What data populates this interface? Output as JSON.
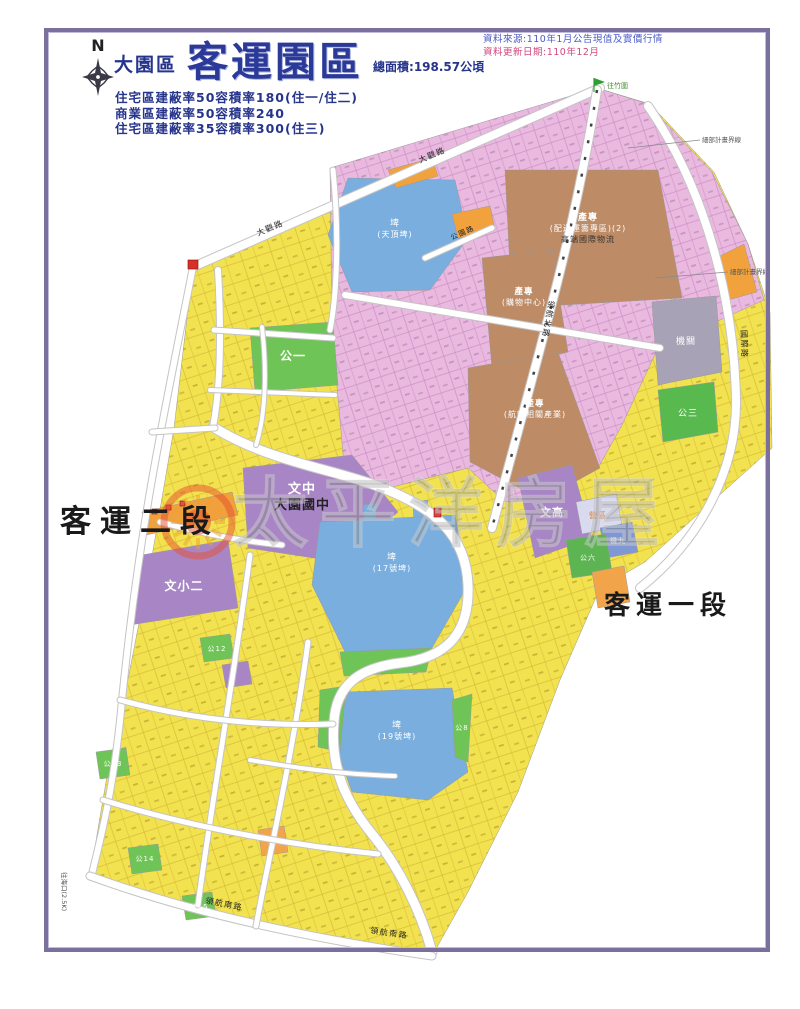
{
  "header": {
    "compass_n": "N",
    "district": "大園區",
    "title": "客運園區",
    "area": "總面積:198.57公頃",
    "regulations": [
      "住宅區建蔽率50容積率180(住一/住二)",
      "商業區建蔽率50容積率240",
      "住宅區建蔽率35容積率300(住三)"
    ],
    "source_line": "資料來源:110年1月公告現值及實價行情",
    "update_line": "資料更新日期:110年12月"
  },
  "palette": {
    "border": "#7a6f9d",
    "title_navy": "#2b3a98",
    "source_blue": "#4a5cc8",
    "source_red": "#d2487e",
    "residential_yellow": "#f2e24f",
    "commercial_pink": "#eab9df",
    "industry_brown": "#bd8b66",
    "pond_blue": "#79aede",
    "park_green": "#6fc457",
    "school_purple": "#a886c6",
    "agency_gray": "#a7a2b5",
    "strip_orange": "#f2a23c"
  },
  "map": {
    "boundary": {
      "name": "plan-area",
      "points": "193,267 480,132 597,88 650,104 714,172 748,244 770,312 772,448 645,562 600,588 560,680 518,792 468,892 432,956 300,932 180,903 90,876 108,770 124,700 152,556 174,428",
      "fill": "#f2e24f",
      "texture": "Y"
    },
    "zones": [
      {
        "name": "commercial-upper",
        "points": "330,168 597,88 648,104 712,172 748,244 764,300 658,348 622,425 598,468 540,498 505,502 468,468 420,480 380,490 345,476 332,330",
        "fill": "#eab9df",
        "texture": "P"
      },
      {
        "name": "pond-top",
        "points": "348,178 455,180 468,238 430,290 352,292 328,235",
        "fill": "#79aede",
        "labels": [
          {
            "t": "埤",
            "c": "#ffffff",
            "s": 9
          },
          {
            "t": "(天頂埤)",
            "c": "#ffffff",
            "s": 8
          }
        ],
        "lx": 395,
        "ly": 226
      },
      {
        "name": "orange-strip-a",
        "points": "388,170 432,158 438,176 396,188",
        "fill": "#f2a23c"
      },
      {
        "name": "orange-strip-b",
        "points": "452,214 490,206 495,230 458,238",
        "fill": "#f2a23c"
      },
      {
        "name": "orange-strip-c",
        "points": "716,258 744,244 757,292 728,300",
        "fill": "#f2a23c"
      },
      {
        "name": "industry-logistics",
        "points": "505,170 658,170 682,298 512,308",
        "fill": "#bd8b66",
        "labels": [
          {
            "t": "產專",
            "c": "#ffffff",
            "s": 9,
            "b": 1
          },
          {
            "t": "(配送運籌專區)(2)",
            "c": "#ffffff",
            "s": 8
          },
          {
            "t": "高端國際物流",
            "c": "#333333",
            "s": 8
          }
        ],
        "lx": 588,
        "ly": 220
      },
      {
        "name": "industry-mall",
        "points": "482,258 552,250 568,352 492,368",
        "fill": "#bd8b66",
        "labels": [
          {
            "t": "產專",
            "c": "#ffffff",
            "s": 8.5,
            "b": 1
          },
          {
            "t": "(購物中心)",
            "c": "#ffffff",
            "s": 8
          }
        ],
        "lx": 524,
        "ly": 294
      },
      {
        "name": "industry-aviation",
        "points": "468,368 558,352 600,468 542,500 470,462",
        "fill": "#bd8b66",
        "labels": [
          {
            "t": "產專",
            "c": "#ffffff",
            "s": 8.5,
            "b": 1
          },
          {
            "t": "(航空相關產業)",
            "c": "#ffffff",
            "s": 8
          }
        ],
        "lx": 535,
        "ly": 406
      },
      {
        "name": "agency",
        "points": "652,302 716,296 722,372 658,385",
        "fill": "#a7a2b5",
        "labels": [
          {
            "t": "機關",
            "c": "#ffffff",
            "s": 9
          }
        ],
        "lx": 686,
        "ly": 344
      },
      {
        "name": "park-3",
        "points": "658,390 714,382 718,432 663,442",
        "fill": "#57b94e",
        "labels": [
          {
            "t": "公三",
            "c": "#ffffff",
            "s": 9
          }
        ],
        "lx": 688,
        "ly": 416
      },
      {
        "name": "park-1",
        "points": "250,328 333,322 338,385 255,392",
        "fill": "#6fc457",
        "labels": [
          {
            "t": "公一",
            "c": "#ffffff",
            "s": 12,
            "b": 1
          }
        ],
        "lx": 293,
        "ly": 360
      },
      {
        "name": "school-junior-high",
        "points": "243,468 352,455 398,512 340,562 248,548",
        "fill": "#a886c6",
        "labels": [
          {
            "t": "文中",
            "c": "#ffffff",
            "s": 13,
            "b": 1
          },
          {
            "t": "大園國中",
            "c": "#222222",
            "s": 13,
            "b": 1
          }
        ],
        "lx": 302,
        "ly": 493
      },
      {
        "name": "school-elementary-2",
        "points": "136,556 228,540 238,608 130,625",
        "fill": "#a886c6",
        "labels": [
          {
            "t": "文小二",
            "c": "#ffffff",
            "s": 12,
            "b": 1
          }
        ],
        "lx": 184,
        "ly": 590
      },
      {
        "name": "orange-strip-left",
        "points": "142,512 232,492 238,515 146,535",
        "fill": "#f0a03c"
      },
      {
        "name": "pond-mid-inlet-1",
        "points": "363,505 377,503 375,528 365,528",
        "fill": "#79aede"
      },
      {
        "name": "pond-mid-inlet-2",
        "points": "413,502 428,500 426,528 414,528",
        "fill": "#79aede"
      },
      {
        "name": "pond-mid",
        "points": "320,522 455,515 468,585 432,648 345,652 312,585",
        "fill": "#79aede",
        "labels": [
          {
            "t": "埤",
            "c": "#ffffff",
            "s": 9
          },
          {
            "t": "(17號埤)",
            "c": "#ffffff",
            "s": 8
          }
        ],
        "lx": 392,
        "ly": 560
      },
      {
        "name": "park-between-ponds",
        "points": "340,652 432,648 426,672 344,676",
        "fill": "#6fc457"
      },
      {
        "name": "pond-low",
        "points": "348,692 452,688 468,772 428,800 352,792 334,742",
        "fill": "#79aede",
        "labels": [
          {
            "t": "埤",
            "c": "#ffffff",
            "s": 9
          },
          {
            "t": "(19號埤)",
            "c": "#ffffff",
            "s": 8
          }
        ],
        "lx": 397,
        "ly": 728
      },
      {
        "name": "park-pond-west",
        "points": "320,690 346,686 340,752 318,747",
        "fill": "#6fc457"
      },
      {
        "name": "park-pond-east",
        "points": "452,700 472,694 468,762 455,757",
        "fill": "#6fc457",
        "labels": [
          {
            "t": "公8",
            "c": "#ffffff",
            "s": 7
          }
        ],
        "lx": 462,
        "ly": 730
      },
      {
        "name": "school-senior-high",
        "points": "518,478 572,465 592,538 535,558",
        "fill": "#a886c6",
        "labels": [
          {
            "t": "文高",
            "c": "#ffffff",
            "s": 11,
            "b": 1
          }
        ],
        "lx": 552,
        "ly": 516
      },
      {
        "name": "camp-block",
        "points": "576,502 616,494 622,526 582,534",
        "fill": "#d8daf0",
        "labels": [
          {
            "t": "營區",
            "c": "#e0781e",
            "s": 8
          }
        ],
        "lx": 598,
        "ly": 518
      },
      {
        "name": "agency-9-block",
        "points": "600,528 632,522 638,552 606,558",
        "fill": "#8097d6",
        "labels": [
          {
            "t": "機九",
            "c": "#ffffff",
            "s": 7
          }
        ],
        "lx": 618,
        "ly": 543
      },
      {
        "name": "park-6-block",
        "points": "566,540 606,534 612,572 572,578",
        "fill": "#5cb552",
        "labels": [
          {
            "t": "公六",
            "c": "#ffffff",
            "s": 7
          }
        ],
        "lx": 588,
        "ly": 560
      },
      {
        "name": "orange-block-east",
        "points": "592,572 624,566 630,602 598,608",
        "fill": "#f2a44a"
      },
      {
        "name": "purple-small-block",
        "points": "222,665 248,661 252,684 226,688",
        "fill": "#a886c6"
      },
      {
        "name": "park-12",
        "points": "200,638 230,634 234,658 204,662",
        "fill": "#6fc457",
        "labels": [
          {
            "t": "公12",
            "c": "#ffffff",
            "s": 7
          }
        ],
        "lx": 217,
        "ly": 651
      },
      {
        "name": "park-13",
        "points": "96,752 126,748 130,775 100,779",
        "fill": "#6fc457",
        "labels": [
          {
            "t": "公13",
            "c": "#ffffff",
            "s": 7
          }
        ],
        "lx": 113,
        "ly": 766
      },
      {
        "name": "park-14",
        "points": "128,848 158,844 162,870 132,874",
        "fill": "#6fc457",
        "labels": [
          {
            "t": "公14",
            "c": "#ffffff",
            "s": 7
          }
        ],
        "lx": 145,
        "ly": 861
      },
      {
        "name": "park-15",
        "points": "182,896 212,892 216,916 186,920",
        "fill": "#6fc457",
        "labels": [
          {
            "t": "公15",
            "c": "#ffffff",
            "s": 7
          }
        ],
        "lx": 199,
        "ly": 909
      },
      {
        "name": "orange-small-south",
        "points": "258,830 284,826 288,852 262,856",
        "fill": "#f2a44a"
      }
    ],
    "roads": [
      {
        "name": "daguan-road",
        "d": "M193,267 L600,88",
        "w": 8,
        "labels": [
          {
            "t": "大觀路",
            "x": 258,
            "y": 236,
            "r": -23,
            "s": 8
          },
          {
            "t": "大觀路",
            "x": 420,
            "y": 163,
            "r": -23,
            "s": 8
          }
        ]
      },
      {
        "name": "linghang-north-road",
        "d": "M597,90 C575,230 545,330 492,528",
        "w": 8,
        "rail": true,
        "labels": [
          {
            "t": "領航北路",
            "x": 549,
            "y": 300,
            "r": 100,
            "s": 8
          }
        ]
      },
      {
        "name": "cross-road-upper",
        "d": "M345,295 L660,348",
        "w": 6,
        "labels": []
      },
      {
        "name": "park-road",
        "d": "M425,258 L492,228",
        "w": 5,
        "labels": [
          {
            "t": "公園路",
            "x": 452,
            "y": 240,
            "r": -24,
            "s": 7
          }
        ]
      },
      {
        "name": "intl-road",
        "d": "M648,106 C706,190 734,300 736,400 C737,470 700,540 640,588",
        "w": 8,
        "labels": [
          {
            "t": "國際路",
            "x": 741,
            "y": 330,
            "r": 88,
            "s": 8
          }
        ]
      },
      {
        "name": "west-edge-road",
        "d": "M193,267 C165,410 140,520 122,700 C114,790 100,840 92,874",
        "w": 6,
        "labels": []
      },
      {
        "name": "s-ring-road",
        "d": "M213,427 C270,462 330,468 380,487 C435,508 466,535 468,585 C470,635 445,658 400,663 C358,668 336,686 334,722 C330,768 346,802 372,834 C398,866 420,908 432,952",
        "w": 9,
        "labels": []
      },
      {
        "name": "linghang-south-road",
        "d": "M90,876 C200,916 320,940 432,956",
        "w": 7,
        "labels": [
          {
            "t": "領航南路",
            "x": 205,
            "y": 903,
            "r": 11,
            "s": 8
          },
          {
            "t": "領航南路",
            "x": 370,
            "y": 933,
            "r": 8,
            "s": 8
          }
        ]
      },
      {
        "name": "col-road-1",
        "d": "M218,270 C222,340 220,390 213,427",
        "w": 6,
        "labels": []
      },
      {
        "name": "col-road-2",
        "d": "M333,170 C340,240 336,300 330,330",
        "w": 5,
        "labels": []
      },
      {
        "name": "grid-a",
        "d": "M250,555 C232,690 212,800 198,905",
        "w": 5,
        "labels": []
      },
      {
        "name": "grid-b",
        "d": "M308,642 C292,760 268,860 256,926",
        "w": 5,
        "labels": []
      },
      {
        "name": "grid-c",
        "d": "M120,700 C200,722 270,726 333,724",
        "w": 5,
        "labels": []
      },
      {
        "name": "grid-d",
        "d": "M103,800 C200,830 300,846 378,854",
        "w": 5,
        "labels": []
      },
      {
        "name": "grid-e",
        "d": "M160,522 C210,536 250,542 282,545",
        "w": 5,
        "labels": []
      },
      {
        "name": "cross-upper-left",
        "d": "M214,330 L333,338",
        "w": 5,
        "labels": []
      },
      {
        "name": "cross-upper-left-2",
        "d": "M210,390 L335,395",
        "w": 4,
        "labels": []
      },
      {
        "name": "upper-col-3",
        "d": "M262,327 C268,380 264,420 256,445",
        "w": 4,
        "labels": []
      },
      {
        "name": "lower-cross",
        "d": "M250,760 C320,772 360,775 395,776",
        "w": 4,
        "labels": []
      },
      {
        "name": "connector",
        "d": "M152,432 L215,428",
        "w": 5,
        "labels": []
      }
    ],
    "markers": [
      {
        "x": 188,
        "y": 260,
        "w": 10,
        "h": 9,
        "fill": "#d93025"
      },
      {
        "x": 434,
        "y": 508,
        "w": 7,
        "h": 9,
        "fill": "#e04040"
      },
      {
        "x": 152,
        "y": 509,
        "w": 5,
        "h": 5,
        "fill": "#e05050"
      },
      {
        "x": 166,
        "y": 505,
        "w": 5,
        "h": 5,
        "fill": "#e05050"
      },
      {
        "x": 180,
        "y": 501,
        "w": 5,
        "h": 5,
        "fill": "#e05050"
      }
    ],
    "annotations": [
      {
        "type": "callout",
        "line": [
          628,
          148,
          700,
          140
        ],
        "t": "細部計畫界線",
        "x": 702,
        "y": 142,
        "s": 6.5,
        "c": "#555555"
      },
      {
        "type": "callout",
        "line": [
          655,
          278,
          728,
          272
        ],
        "t": "細部計畫界線",
        "x": 730,
        "y": 274,
        "s": 6.5,
        "c": "#555555"
      },
      {
        "type": "flag",
        "x": 594,
        "y": 78
      },
      {
        "type": "text",
        "t": "往竹圍",
        "x": 607,
        "y": 88,
        "s": 7,
        "c": "#3f8f2f"
      },
      {
        "type": "vtext",
        "t": "往海口(2.5K)",
        "x": 62,
        "y": 872,
        "s": 6.5,
        "c": "#555555"
      }
    ],
    "big_labels": [
      {
        "name": "keyun-section-2",
        "t": "客運二段",
        "x": 60,
        "y": 532,
        "s": 31,
        "ls": 9
      },
      {
        "name": "keyun-section-1",
        "t": "客運一段",
        "x": 604,
        "y": 614,
        "s": 26,
        "ls": 6
      }
    ],
    "watermark": {
      "text": "太平洋房屋"
    }
  }
}
